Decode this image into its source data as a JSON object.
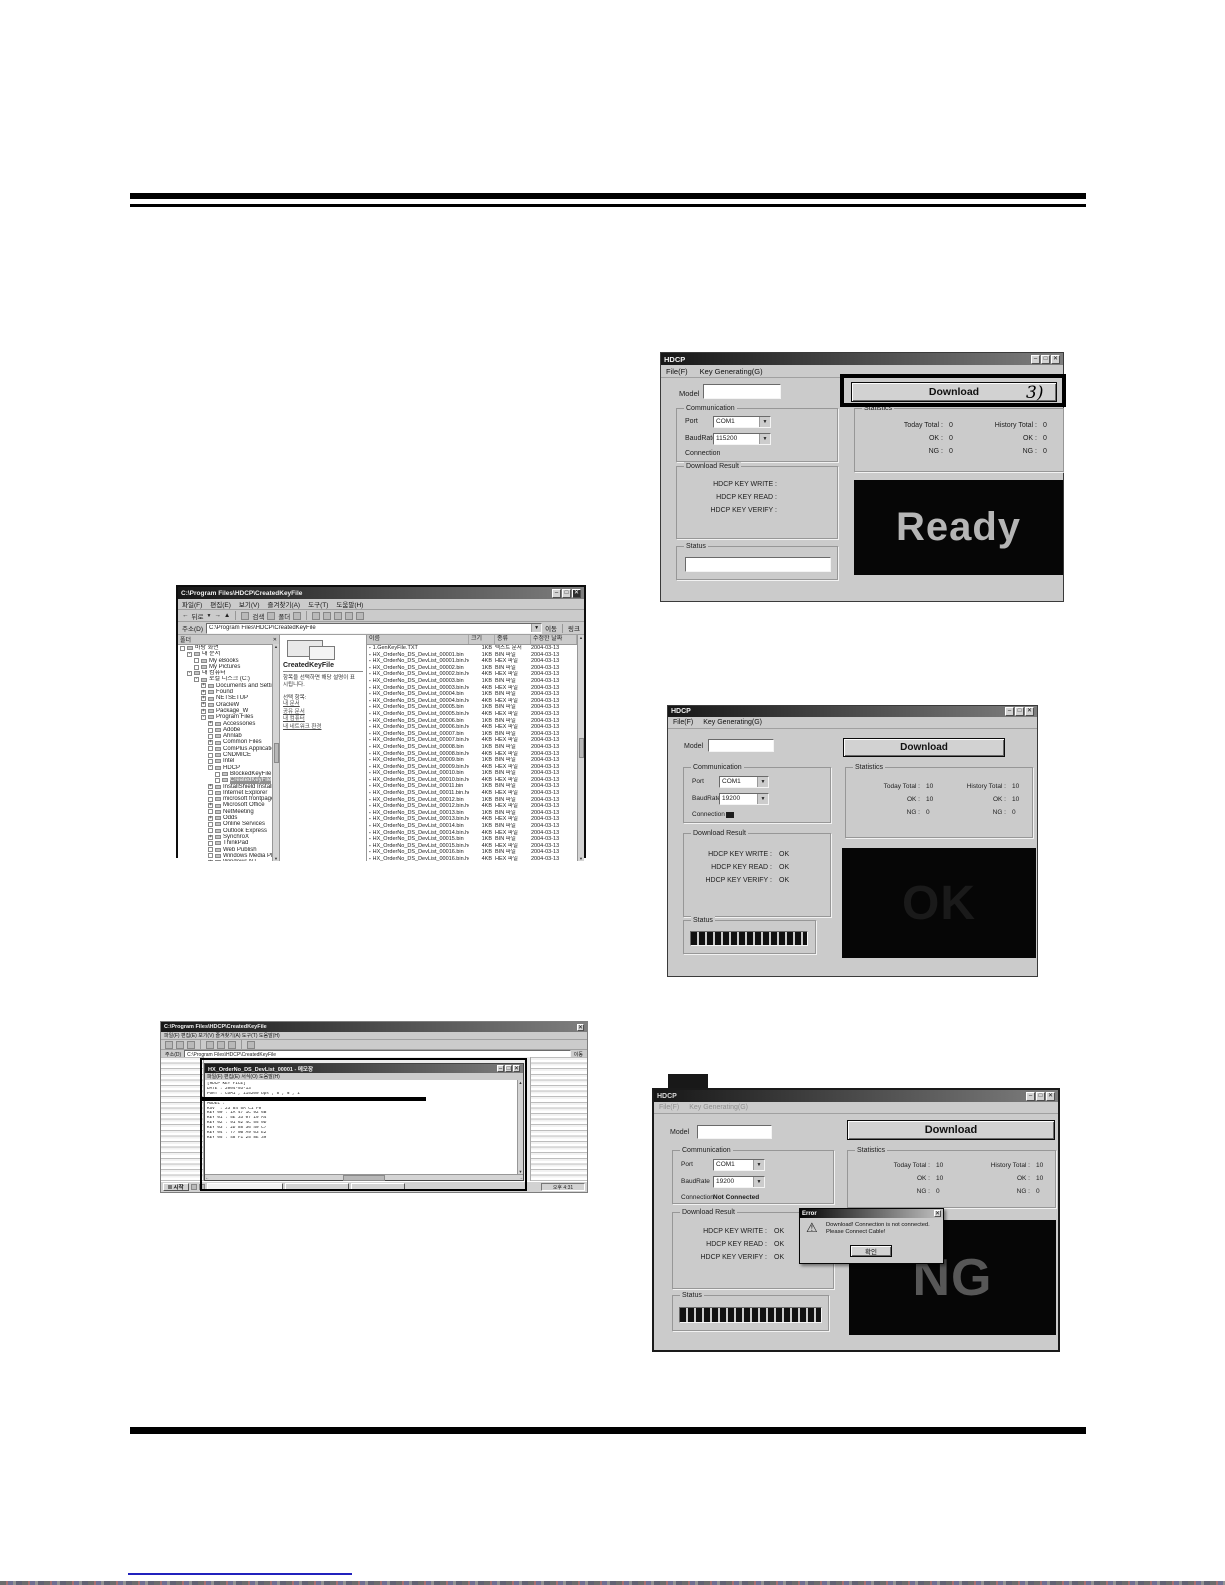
{
  "icons": {
    "min": "–",
    "max": "□",
    "close": "✕",
    "down": "▼",
    "up": "▲",
    "left": "←",
    "right": "→",
    "warning": "⚠",
    "file_bullet": "▪"
  },
  "annotations": {
    "step3": "3)"
  },
  "labels": {
    "title": "HDCP",
    "menu_file": "File(F)",
    "menu_keygen": "Key Generating(G)",
    "model": "Model",
    "communication": "Communication",
    "port": "Port",
    "baudrate": "BaudRate",
    "connection": "Connection",
    "download_result": "Download Result",
    "write": "HDCP KEY WRITE :",
    "read": "HDCP KEY READ :",
    "verify": "HDCP KEY VERIFY :",
    "status": "Status",
    "statistics": "Statistics",
    "today_total": "Today Total :",
    "history_total": "History Total :",
    "ok": "OK :",
    "ng": "NG :",
    "download": "Download"
  },
  "ready_win": {
    "port": "COM1",
    "baud": "115200",
    "connection_value": "",
    "write": "",
    "read": "",
    "verify": "",
    "today": [
      "0",
      "0",
      "0"
    ],
    "history": [
      "0",
      "0",
      "0"
    ],
    "display": "Ready"
  },
  "ok_win": {
    "port": "COM1",
    "baud": "19200",
    "write": "OK",
    "read": "OK",
    "verify": "OK",
    "today": [
      "10",
      "10",
      "0"
    ],
    "history": [
      "10",
      "10",
      "0"
    ],
    "display": "OK"
  },
  "ng_win": {
    "port": "COM1",
    "baud": "19200",
    "connection_value": "Not Connected",
    "write": "OK",
    "read": "OK",
    "verify": "OK",
    "today": [
      "10",
      "10",
      "0"
    ],
    "history": [
      "10",
      "10",
      "0"
    ],
    "display": "NG",
    "dialog": {
      "title": "Error",
      "line1": "Download! Connection is not connected.",
      "line2": "Please Connect Cable!",
      "button": "확인"
    }
  },
  "explorer": {
    "title": "C:\\Program Files\\HDCP\\CreatedKeyFile",
    "menu": [
      "파일(F)",
      "편집(E)",
      "보기(V)",
      "즐겨찾기(A)",
      "도구(T)",
      "도움말(H)"
    ],
    "toolbar": {
      "back": "뒤로",
      "search": "검색",
      "folders": "폴더"
    },
    "address_label": "주소(D)",
    "address": "C:\\Program Files\\HDCP\\CreatedKeyFile",
    "go": "이동",
    "links_label": "링크",
    "folders_header": "폴더",
    "pane": {
      "title": "CreatedKeyFile",
      "desc1": "항목을 선택하면 해당 설명이 표",
      "desc2": "시됩니다.",
      "sel_label": "선택 항목:",
      "links": [
        "내 문서",
        "공유 문서",
        "내 컴퓨터",
        "내 네트워크 환경"
      ]
    },
    "columns": [
      "이름",
      "크기",
      "종류",
      "수정한 날짜"
    ],
    "tree": [
      {
        "box": "",
        "label": "바탕 화면",
        "pad": 2
      },
      {
        "box": "-",
        "label": "내 문서",
        "pad": 9
      },
      {
        "box": "",
        "label": "My eBooks",
        "pad": 16
      },
      {
        "box": "",
        "label": "My Pictures",
        "pad": 16
      },
      {
        "box": "-",
        "label": "내 컴퓨터",
        "pad": 9
      },
      {
        "box": "-",
        "label": "로컬 디스크 (C:)",
        "pad": 16
      },
      {
        "box": "+",
        "label": "Documents and Settings",
        "pad": 23
      },
      {
        "box": "+",
        "label": "Found",
        "pad": 23
      },
      {
        "box": "+",
        "label": "NETSETUP",
        "pad": 23
      },
      {
        "box": "+",
        "label": "OracleW",
        "pad": 23
      },
      {
        "box": "+",
        "label": "Package_W",
        "pad": 23
      },
      {
        "box": "-",
        "label": "Program Files",
        "pad": 23
      },
      {
        "box": "+",
        "label": "Accessories",
        "pad": 30
      },
      {
        "box": "",
        "label": "Adobe",
        "pad": 30
      },
      {
        "box": "",
        "label": "Ahnlab",
        "pad": 30
      },
      {
        "box": "+",
        "label": "Common Files",
        "pad": 30
      },
      {
        "box": "",
        "label": "ComPlus Applications",
        "pad": 30
      },
      {
        "box": "",
        "label": "CNDMICE",
        "pad": 30
      },
      {
        "box": "",
        "label": "Intel",
        "pad": 30
      },
      {
        "box": "-",
        "label": "HDCP",
        "pad": 30
      },
      {
        "box": "",
        "label": "BlockedKeyFile",
        "pad": 37
      },
      {
        "box": "",
        "label": "CreatedKeyFile",
        "pad": 37,
        "_class": "sel"
      },
      {
        "box": "+",
        "label": "InstallShield Installation Inf...",
        "pad": 30
      },
      {
        "box": "",
        "label": "Internet Explorer",
        "pad": 30
      },
      {
        "box": "",
        "label": "microsoft frontpage",
        "pad": 30
      },
      {
        "box": "+",
        "label": "Microsoft Office",
        "pad": 30
      },
      {
        "box": "",
        "label": "NetMeeting",
        "pad": 30
      },
      {
        "box": "+",
        "label": "Odds",
        "pad": 30
      },
      {
        "box": "",
        "label": "Online Services",
        "pad": 30
      },
      {
        "box": "",
        "label": "Outlook Express",
        "pad": 30
      },
      {
        "box": "+",
        "label": "SynchroX",
        "pad": 30
      },
      {
        "box": "",
        "label": "ThinkPad",
        "pad": 30
      },
      {
        "box": "",
        "label": "Web Publish",
        "pad": 30
      },
      {
        "box": "",
        "label": "Windows Media Player",
        "pad": 30
      },
      {
        "box": "+",
        "label": "Windows NT",
        "pad": 30
      },
      {
        "box": "",
        "label": "WindowsUpdate",
        "pad": 30
      }
    ],
    "files": [
      {
        "name": "1.GenKeyFile.TXT",
        "size": "1KB",
        "type": "텍스트 문서",
        "date": "2004-03-13"
      },
      {
        "name": "HX_OrderNo_DS_DevList_00001.bin",
        "size": "1KB",
        "type": "BIN 파일",
        "date": "2004-03-13"
      },
      {
        "name": "HX_OrderNo_DS_DevList_00001.bin.hex",
        "size": "4KB",
        "type": "HEX 파일",
        "date": "2004-03-13"
      },
      {
        "name": "HX_OrderNo_DS_DevList_00002.bin",
        "size": "1KB",
        "type": "BIN 파일",
        "date": "2004-03-13"
      },
      {
        "name": "HX_OrderNo_DS_DevList_00002.bin.hex",
        "size": "4KB",
        "type": "HEX 파일",
        "date": "2004-03-13"
      },
      {
        "name": "HX_OrderNo_DS_DevList_00003.bin",
        "size": "1KB",
        "type": "BIN 파일",
        "date": "2004-03-13"
      },
      {
        "name": "HX_OrderNo_DS_DevList_00003.bin.hex",
        "size": "4KB",
        "type": "HEX 파일",
        "date": "2004-03-13"
      },
      {
        "name": "HX_OrderNo_DS_DevList_00004.bin",
        "size": "1KB",
        "type": "BIN 파일",
        "date": "2004-03-13"
      },
      {
        "name": "HX_OrderNo_DS_DevList_00004.bin.hex",
        "size": "4KB",
        "type": "HEX 파일",
        "date": "2004-03-13"
      },
      {
        "name": "HX_OrderNo_DS_DevList_00005.bin",
        "size": "1KB",
        "type": "BIN 파일",
        "date": "2004-03-13"
      },
      {
        "name": "HX_OrderNo_DS_DevList_00005.bin.hex",
        "size": "4KB",
        "type": "HEX 파일",
        "date": "2004-03-13"
      },
      {
        "name": "HX_OrderNo_DS_DevList_00006.bin",
        "size": "1KB",
        "type": "BIN 파일",
        "date": "2004-03-13"
      },
      {
        "name": "HX_OrderNo_DS_DevList_00006.bin.hex",
        "size": "4KB",
        "type": "HEX 파일",
        "date": "2004-03-13"
      },
      {
        "name": "HX_OrderNo_DS_DevList_00007.bin",
        "size": "1KB",
        "type": "BIN 파일",
        "date": "2004-03-13"
      },
      {
        "name": "HX_OrderNo_DS_DevList_00007.bin.hex",
        "size": "4KB",
        "type": "HEX 파일",
        "date": "2004-03-13"
      },
      {
        "name": "HX_OrderNo_DS_DevList_00008.bin",
        "size": "1KB",
        "type": "BIN 파일",
        "date": "2004-03-13"
      },
      {
        "name": "HX_OrderNo_DS_DevList_00008.bin.hex",
        "size": "4KB",
        "type": "HEX 파일",
        "date": "2004-03-13"
      },
      {
        "name": "HX_OrderNo_DS_DevList_00009.bin",
        "size": "1KB",
        "type": "BIN 파일",
        "date": "2004-03-13"
      },
      {
        "name": "HX_OrderNo_DS_DevList_00009.bin.hex",
        "size": "4KB",
        "type": "HEX 파일",
        "date": "2004-03-13"
      },
      {
        "name": "HX_OrderNo_DS_DevList_00010.bin",
        "size": "1KB",
        "type": "BIN 파일",
        "date": "2004-03-13"
      },
      {
        "name": "HX_OrderNo_DS_DevList_00010.bin.hex",
        "size": "4KB",
        "type": "HEX 파일",
        "date": "2004-03-13"
      },
      {
        "name": "HX_OrderNo_DS_DevList_00011.bin",
        "size": "1KB",
        "type": "BIN 파일",
        "date": "2004-03-13"
      },
      {
        "name": "HX_OrderNo_DS_DevList_00011.bin.hex",
        "size": "4KB",
        "type": "HEX 파일",
        "date": "2004-03-13"
      },
      {
        "name": "HX_OrderNo_DS_DevList_00012.bin",
        "size": "1KB",
        "type": "BIN 파일",
        "date": "2004-03-13"
      },
      {
        "name": "HX_OrderNo_DS_DevList_00012.bin.hex",
        "size": "4KB",
        "type": "HEX 파일",
        "date": "2004-03-13"
      },
      {
        "name": "HX_OrderNo_DS_DevList_00013.bin",
        "size": "1KB",
        "type": "BIN 파일",
        "date": "2004-03-13"
      },
      {
        "name": "HX_OrderNo_DS_DevList_00013.bin.hex",
        "size": "4KB",
        "type": "HEX 파일",
        "date": "2004-03-13"
      },
      {
        "name": "HX_OrderNo_DS_DevList_00014.bin",
        "size": "1KB",
        "type": "BIN 파일",
        "date": "2004-03-13"
      },
      {
        "name": "HX_OrderNo_DS_DevList_00014.bin.hex",
        "size": "4KB",
        "type": "HEX 파일",
        "date": "2004-03-13"
      },
      {
        "name": "HX_OrderNo_DS_DevList_00015.bin",
        "size": "1KB",
        "type": "BIN 파일",
        "date": "2004-03-13"
      },
      {
        "name": "HX_OrderNo_DS_DevList_00015.bin.hex",
        "size": "4KB",
        "type": "HEX 파일",
        "date": "2004-03-13"
      },
      {
        "name": "HX_OrderNo_DS_DevList_00016.bin",
        "size": "1KB",
        "type": "BIN 파일",
        "date": "2004-03-13"
      },
      {
        "name": "HX_OrderNo_DS_DevList_00016.bin.hex",
        "size": "4KB",
        "type": "HEX 파일",
        "date": "2004-03-13"
      }
    ]
  },
  "editor": {
    "back_title": "C:\\Program Files\\HDCP\\CreatedKeyFile",
    "back_menu": "파일(F)   편집(E)   보기(V)   즐겨찾기(A)   도구(T)   도움말(H)",
    "address_label": "주소(D)",
    "address": "C:\\Program Files\\HDCP\\CreatedKeyFile",
    "go": "이동",
    "notepad": {
      "title": "HX_OrderNo_DS_DevList_00001 - 메모장",
      "menu": "파일(F)  편집(E)  서식(O)  도움말(H)",
      "lines": [
        "[HDCP KEY FILE]",
        "DATE : 2004-03-13",
        "PORT : COM1 , 115200 bps , 8 , N , 1",
        "PATH : C:\\Program Files\\HDCP\\PC",
        "MODEL :",
        "KSV  : 23 84 5A C1 F0",
        "KEY 00 : 1A 47 1C 92 6B",
        "KEY 01 : 5E 33 07 19 A4",
        "KEY 02 : 91 62 4C 55 0D",
        "KEY 03 : 2D 88 36 40 C7",
        "KEY 04 : 77 0B A9 63 E2",
        "KEY 05 : 48 F1 25 8E 39"
      ]
    },
    "taskbar": {
      "start": "시작",
      "time": "오후 4:31"
    }
  }
}
